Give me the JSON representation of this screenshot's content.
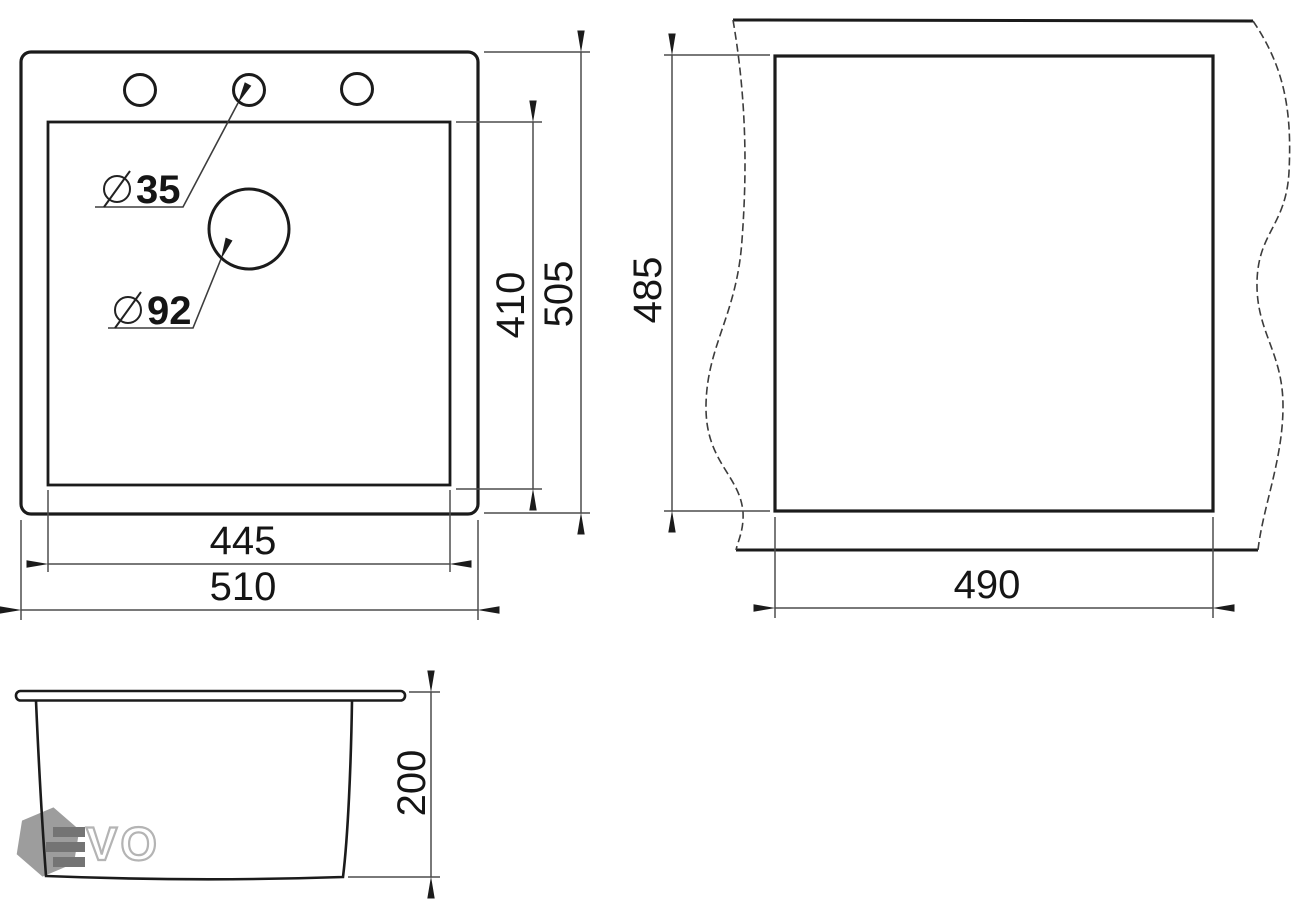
{
  "drawing_type": "sink-technical-dimension-drawing",
  "top_view": {
    "faucet_hole_diameter": "35",
    "drain_hole_diameter": "92",
    "inner_width": "445",
    "outer_width": "510",
    "inner_height": "410",
    "outer_height": "505"
  },
  "cutout_view": {
    "cutout_height": "485",
    "cutout_width": "490"
  },
  "side_view": {
    "depth": "200"
  },
  "logo": {
    "text": "VO",
    "mark": "hexagon-with-e-bars"
  },
  "colors": {
    "background": "#ffffff",
    "outline": "#1b1b1b",
    "dimension_line": "#4d4d4d",
    "text": "#151515",
    "logo_hexagon": "#9d9d9d",
    "logo_bars": "#747474",
    "logo_letter_outline": "#b4b4b4"
  }
}
